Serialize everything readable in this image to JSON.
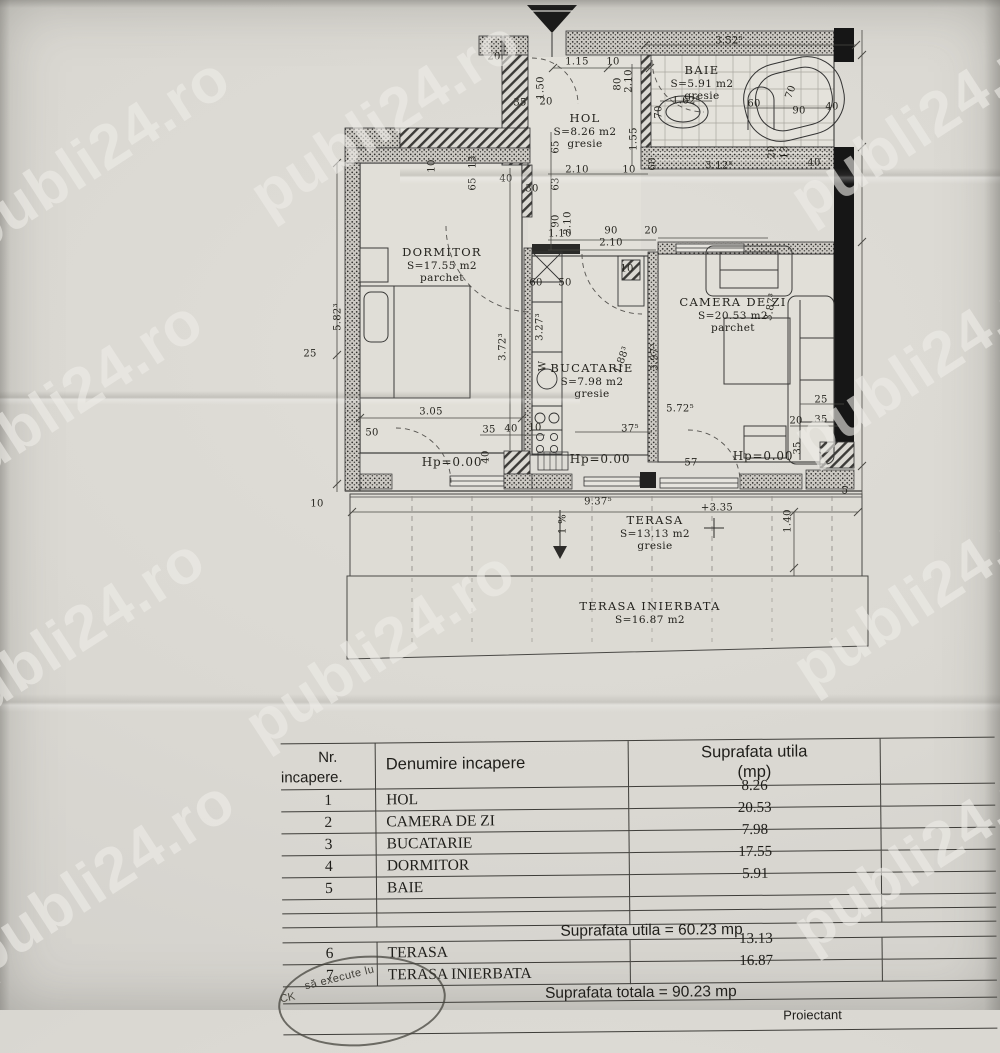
{
  "watermark": {
    "text": "publi24.ro"
  },
  "plan": {
    "rooms": [
      {
        "name": "HOL",
        "area": "S=8.26 m2",
        "floor": "gresie"
      },
      {
        "name": "BAIE",
        "area": "S=5.91 m2",
        "floor": "gresie"
      },
      {
        "name": "DORMITOR",
        "area": "S=17.55 m2",
        "floor": "parchet"
      },
      {
        "name": "BUCATARIE",
        "area": "S=7.98 m2",
        "floor": "gresie"
      },
      {
        "name": "CAMERA DE ZI",
        "area": "S=20.53 m2",
        "floor": "parchet"
      },
      {
        "name": "TERASA",
        "area": "S=13.13 m2",
        "floor": "gresie"
      },
      {
        "name": "TERASA INIERBATA",
        "area": "S=16.87 m2",
        "floor": ""
      }
    ],
    "dims": [
      {
        "t": "20",
        "x": 494,
        "y": 57
      },
      {
        "t": "35",
        "x": 520,
        "y": 103
      },
      {
        "t": "20",
        "x": 546,
        "y": 102
      },
      {
        "t": "1.15",
        "x": 577,
        "y": 62
      },
      {
        "t": "10",
        "x": 613,
        "y": 62
      },
      {
        "t": "1.50",
        "x": 541,
        "y": 88,
        "r": -90
      },
      {
        "t": "80",
        "x": 618,
        "y": 84,
        "r": -90
      },
      {
        "t": "2.10",
        "x": 629,
        "y": 81,
        "r": -90
      },
      {
        "t": "65",
        "x": 556,
        "y": 147,
        "r": -90
      },
      {
        "t": "63",
        "x": 556,
        "y": 184,
        "r": -90
      },
      {
        "t": "90",
        "x": 556,
        "y": 221,
        "r": -90
      },
      {
        "t": "2.10",
        "x": 568,
        "y": 223,
        "r": -90
      },
      {
        "t": "1.55",
        "x": 634,
        "y": 139,
        "r": -90
      },
      {
        "t": "2.10",
        "x": 577,
        "y": 170
      },
      {
        "t": "10",
        "x": 629,
        "y": 170
      },
      {
        "t": "3.52⁵",
        "x": 729,
        "y": 41
      },
      {
        "t": "1.62⁵",
        "x": 686,
        "y": 101
      },
      {
        "t": "70",
        "x": 659,
        "y": 112,
        "r": -90
      },
      {
        "t": "60",
        "x": 754,
        "y": 104
      },
      {
        "t": "70",
        "x": 791,
        "y": 92,
        "r": -70
      },
      {
        "t": "90",
        "x": 799,
        "y": 111
      },
      {
        "t": "40",
        "x": 832,
        "y": 107
      },
      {
        "t": "20",
        "x": 772,
        "y": 152,
        "r": -90
      },
      {
        "t": "13",
        "x": 785,
        "y": 152,
        "r": -90
      },
      {
        "t": "60",
        "x": 653,
        "y": 164,
        "r": -90
      },
      {
        "t": "3.12⁵",
        "x": 719,
        "y": 166
      },
      {
        "t": "40",
        "x": 814,
        "y": 163
      },
      {
        "t": "10",
        "x": 432,
        "y": 166,
        "r": -90
      },
      {
        "t": "13",
        "x": 473,
        "y": 162,
        "r": -90
      },
      {
        "t": "65",
        "x": 473,
        "y": 184,
        "r": -90
      },
      {
        "t": "40",
        "x": 506,
        "y": 179
      },
      {
        "t": "30",
        "x": 532,
        "y": 189
      },
      {
        "t": "90",
        "x": 611,
        "y": 231
      },
      {
        "t": "2.10",
        "x": 611,
        "y": 243
      },
      {
        "t": "20",
        "x": 651,
        "y": 231
      },
      {
        "t": "1.10",
        "x": 560,
        "y": 234
      },
      {
        "t": "60",
        "x": 536,
        "y": 283
      },
      {
        "t": "50",
        "x": 565,
        "y": 283
      },
      {
        "t": "10",
        "x": 627,
        "y": 269
      },
      {
        "t": "3.27³",
        "x": 540,
        "y": 327,
        "r": -90
      },
      {
        "t": "W",
        "x": 543,
        "y": 366,
        "r": -90
      },
      {
        "t": "1.88³",
        "x": 622,
        "y": 360,
        "r": -70
      },
      {
        "t": "3.97³",
        "x": 655,
        "y": 357,
        "r": -90
      },
      {
        "t": "3.87³",
        "x": 771,
        "y": 307,
        "r": -80
      },
      {
        "t": "5.82³",
        "x": 338,
        "y": 317,
        "r": -90
      },
      {
        "t": "3.72³",
        "x": 503,
        "y": 347,
        "r": -90
      },
      {
        "t": "25",
        "x": 310,
        "y": 354
      },
      {
        "t": "3.05",
        "x": 431,
        "y": 412
      },
      {
        "t": "50",
        "x": 372,
        "y": 433
      },
      {
        "t": "35",
        "x": 489,
        "y": 430
      },
      {
        "t": "40",
        "x": 511,
        "y": 429
      },
      {
        "t": "10",
        "x": 535,
        "y": 428
      },
      {
        "t": "37⁵",
        "x": 630,
        "y": 429
      },
      {
        "t": "57",
        "x": 691,
        "y": 463
      },
      {
        "t": "5.72⁵",
        "x": 680,
        "y": 409
      },
      {
        "t": "40",
        "x": 486,
        "y": 457,
        "r": -90
      },
      {
        "t": "25",
        "x": 821,
        "y": 400
      },
      {
        "t": "20",
        "x": 796,
        "y": 421
      },
      {
        "t": "35",
        "x": 821,
        "y": 420
      },
      {
        "t": "35",
        "x": 798,
        "y": 448,
        "r": -90
      },
      {
        "t": "Hp=0.00",
        "x": 452,
        "y": 462,
        "cls": "hp"
      },
      {
        "t": "Hp=0.00",
        "x": 600,
        "y": 459,
        "cls": "hp"
      },
      {
        "t": "Hp=0.00",
        "x": 763,
        "y": 456,
        "cls": "hp"
      },
      {
        "t": "10",
        "x": 317,
        "y": 504
      },
      {
        "t": "9.37⁵",
        "x": 598,
        "y": 502
      },
      {
        "t": "1 %",
        "x": 563,
        "y": 524,
        "r": -90
      },
      {
        "t": "+3.35",
        "x": 717,
        "y": 508
      },
      {
        "t": "1.40",
        "x": 788,
        "y": 521,
        "r": -90
      },
      {
        "t": "5",
        "x": 845,
        "y": 491
      }
    ]
  },
  "table": {
    "col1_header_line1": "Nr.",
    "col1_header_line2": "incapere.",
    "col2_header": "Denumire incapere",
    "col3_header_line1": "Suprafata utila",
    "col3_header_line2": "(mp)",
    "rows": [
      {
        "nr": "1",
        "name": "HOL",
        "value": "8.26"
      },
      {
        "nr": "2",
        "name": "CAMERA DE ZI",
        "value": "20.53"
      },
      {
        "nr": "3",
        "name": "BUCATARIE",
        "value": "7.98"
      },
      {
        "nr": "4",
        "name": "DORMITOR",
        "value": "17.55"
      },
      {
        "nr": "5",
        "name": "BAIE",
        "value": "5.91"
      },
      {
        "nr": "",
        "name": "",
        "value": ""
      },
      {
        "nr": "",
        "name": "",
        "value": ""
      }
    ],
    "subtotal": "Suprafata utila = 60.23 mp",
    "rows2": [
      {
        "nr": "6",
        "name": "TERASA",
        "value": "13.13"
      },
      {
        "nr": "7",
        "name": "TERASA INIERBATA",
        "value": "16.87"
      }
    ],
    "total": "Suprafata totala = 90.23 mp"
  },
  "stamp": {
    "text": "să execute lu",
    "text2": "CK"
  },
  "footer": {
    "partial": "Proiectant"
  }
}
